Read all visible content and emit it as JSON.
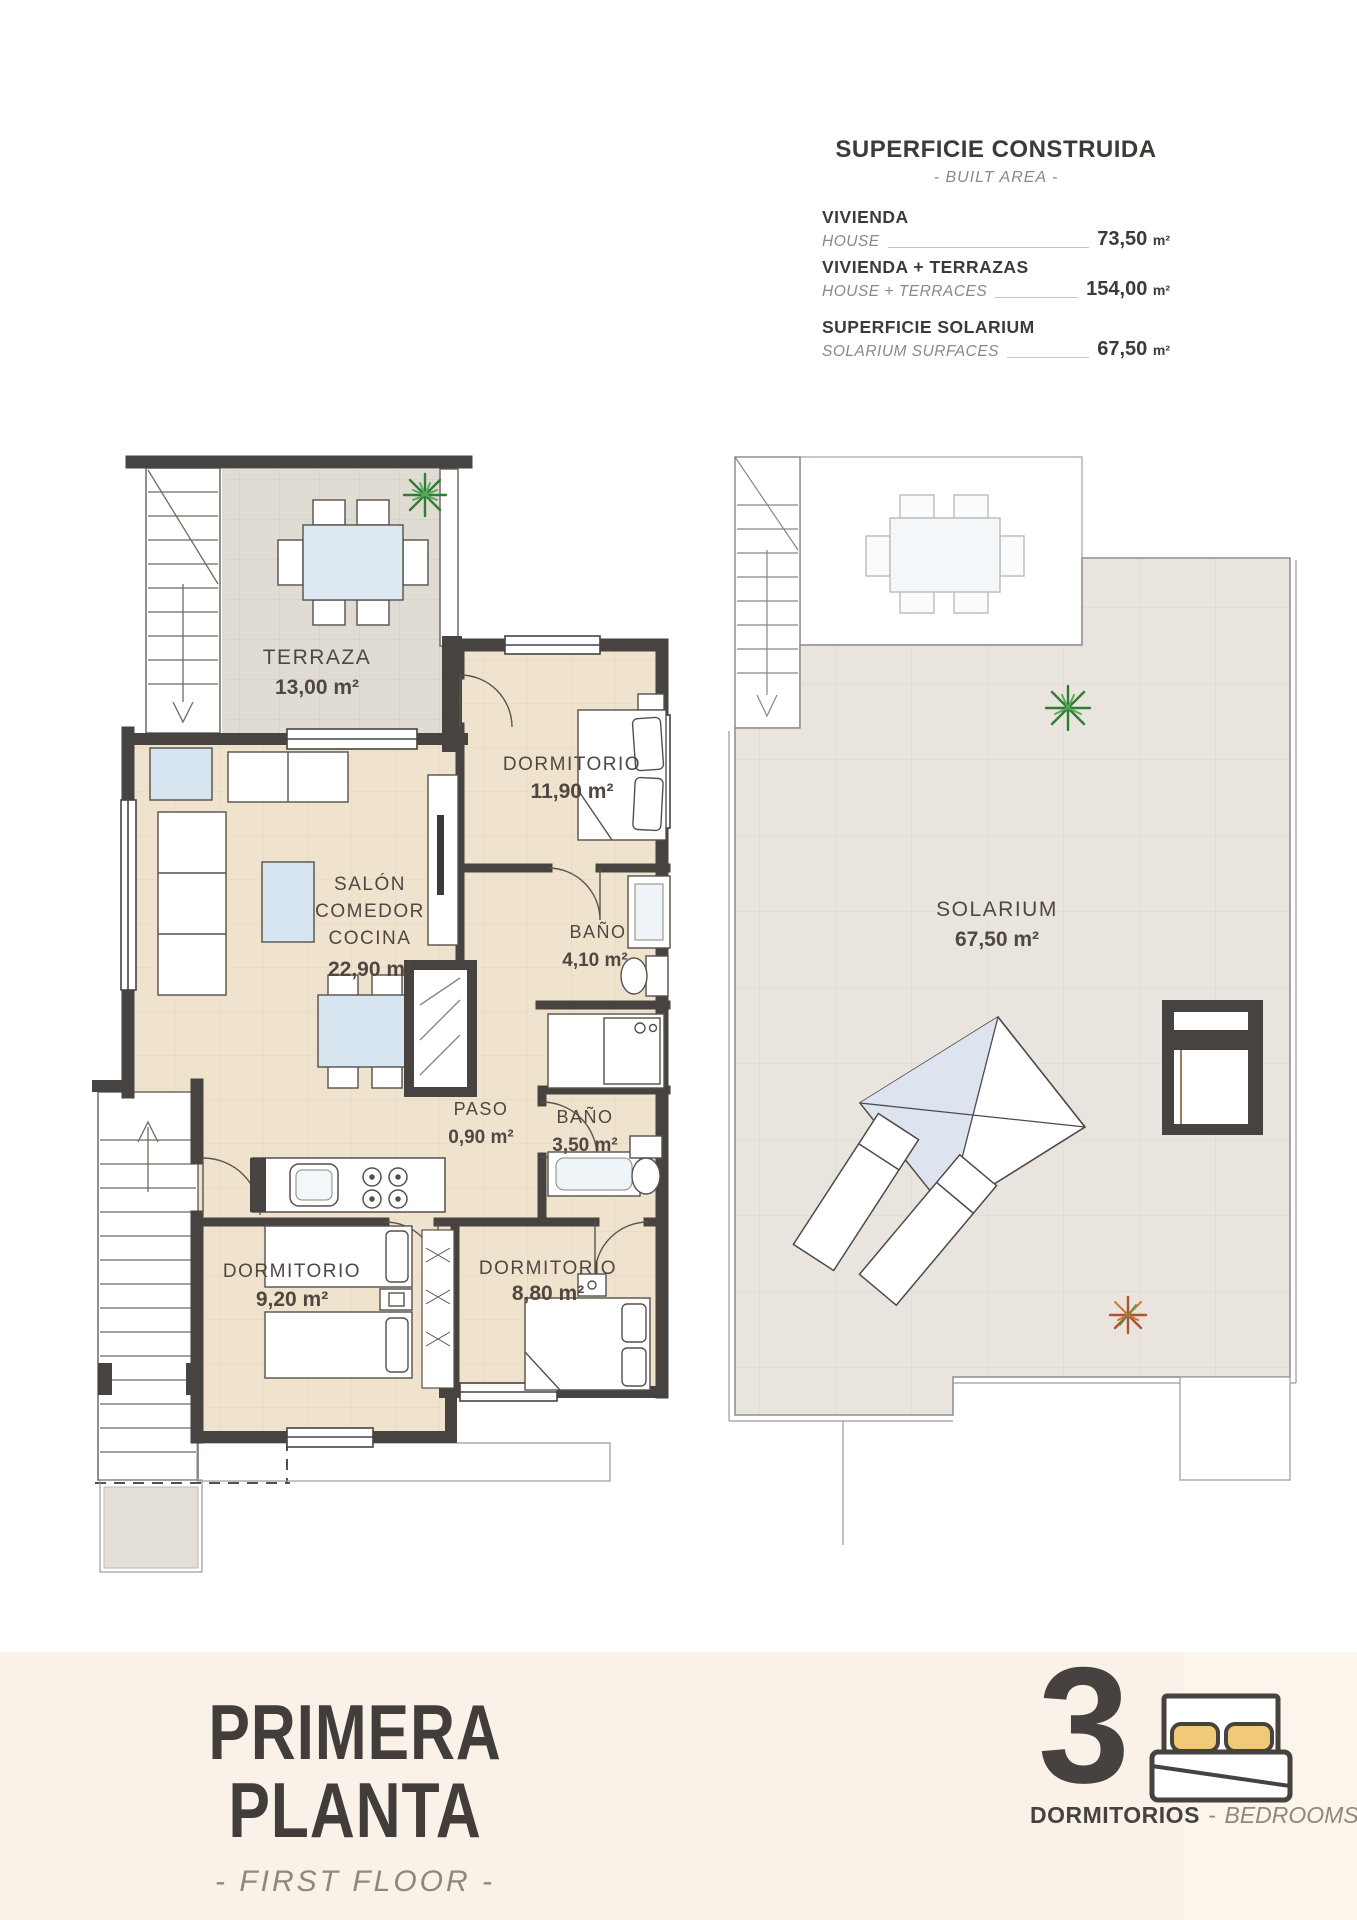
{
  "header": {
    "title": "SUPERFICIE CONSTRUIDA",
    "subtitle": "- BUILT AREA -",
    "rows": [
      {
        "label_es": "VIVIENDA",
        "label_en": "HOUSE",
        "value": "73,50",
        "unit": "m²"
      },
      {
        "label_es": "VIVIENDA + TERRAZAS",
        "label_en": "HOUSE + TERRACES",
        "value": "154,00",
        "unit": "m²"
      },
      {
        "label_es": "SUPERFICIE SOLARIUM",
        "label_en": "SOLARIUM SURFACES",
        "value": "67,50",
        "unit": "m²"
      }
    ]
  },
  "plan": {
    "rooms": {
      "terraza": {
        "name": "TERRAZA",
        "area": "13,00 m²"
      },
      "dormitorio_1": {
        "name": "DORMITORIO",
        "area": "11,90 m²"
      },
      "salon": {
        "line1": "SALÓN",
        "line2": "COMEDOR",
        "line3": "COCINA",
        "area": "22,90 m²"
      },
      "bano_1": {
        "name": "BAÑO",
        "area": "4,10 m²"
      },
      "paso": {
        "name": "PASO",
        "area": "0,90 m²"
      },
      "bano_2": {
        "name": "BAÑO",
        "area": "3,50 m²"
      },
      "dormitorio_2": {
        "name": "DORMITORIO",
        "area": "9,20 m²"
      },
      "dormitorio_3": {
        "name": "DORMITORIO",
        "area": "8,80 m²"
      },
      "solarium": {
        "name": "SOLARIUM",
        "area": "67,50 m²"
      }
    }
  },
  "footer": {
    "title": "PRIMERA PLANTA",
    "subtitle": "- FIRST FLOOR -",
    "bedrooms_count": "3",
    "bedrooms_label_es": "DORMITORIOS",
    "separator": "-",
    "bedrooms_label_en": "BEDROOMS"
  }
}
